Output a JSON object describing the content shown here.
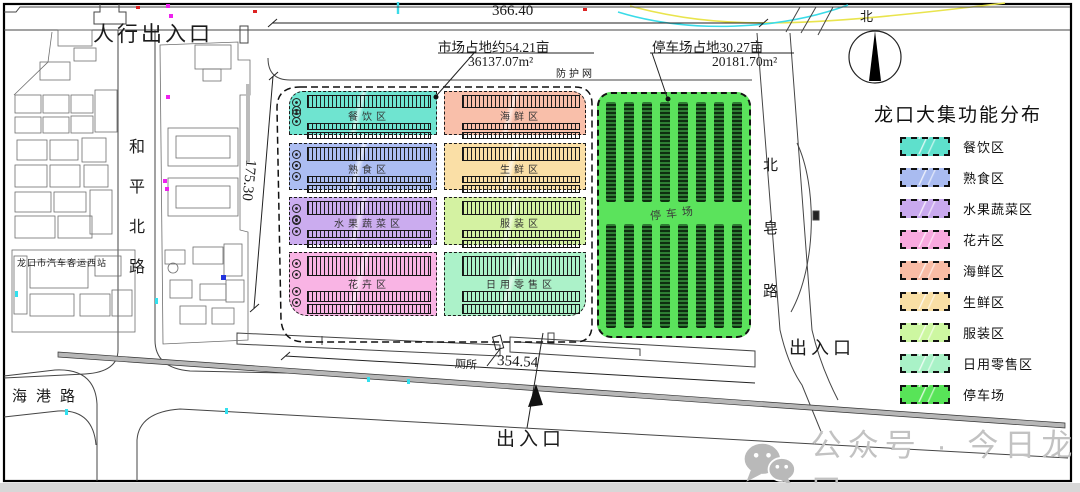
{
  "title": "龙口大集功能分布",
  "compass": {
    "north_label": "北"
  },
  "dimensions": {
    "top_width": "366.40",
    "left_height": "175.30",
    "bottom_width": "354.54"
  },
  "annotations": {
    "market_area": "市场占地约54.21亩",
    "market_area_m2": "36137.07m²",
    "fence": "防护网",
    "parking_area": "停车场占地30.27亩",
    "parking_area_m2": "20181.70m²",
    "pedestrian_entrance": "人行出入口",
    "entrance_bottom": "出入口",
    "entrance_right": "出入口",
    "toilet": "厕所",
    "bus_station": "龙口市汽车客运西站"
  },
  "roads": {
    "west": "和平北路",
    "south": "海港路",
    "east": "北皂路"
  },
  "zones": {
    "rows": [
      {
        "left": {
          "label": "餐饮区",
          "color": "#6FE4D0"
        },
        "right": {
          "label": "海鲜区",
          "color": "#F9BFAA"
        }
      },
      {
        "left": {
          "label": "熟食区",
          "color": "#ACBDF2"
        },
        "right": {
          "label": "生鲜区",
          "color": "#FADFA6"
        }
      },
      {
        "left": {
          "label": "水果蔬菜区",
          "color": "#CBACEF"
        },
        "right": {
          "label": "服装区",
          "color": "#D4F2A2"
        }
      },
      {
        "left": {
          "label": "花卉区",
          "color": "#F9B4E4"
        },
        "right": {
          "label": "日用零售区",
          "color": "#ACF2C9"
        }
      }
    ],
    "parking": {
      "label": "停车场",
      "color": "#5BE35C"
    }
  },
  "legend": {
    "title": "龙口大集功能分布",
    "items": [
      {
        "label": "餐饮区",
        "color": "#5EE0CC"
      },
      {
        "label": "熟食区",
        "color": "#A9BBF0"
      },
      {
        "label": "水果蔬菜区",
        "color": "#C9A9EE"
      },
      {
        "label": "花卉区",
        "color": "#F9A9DF"
      },
      {
        "label": "海鲜区",
        "color": "#F9BCA5"
      },
      {
        "label": "生鲜区",
        "color": "#F9DFA5"
      },
      {
        "label": "服装区",
        "color": "#CDF7A1"
      },
      {
        "label": "日用零售区",
        "color": "#A9F2C7"
      },
      {
        "label": "停车场",
        "color": "#58E458"
      }
    ]
  },
  "watermark": {
    "text": "公众号 · 今日龙口"
  }
}
